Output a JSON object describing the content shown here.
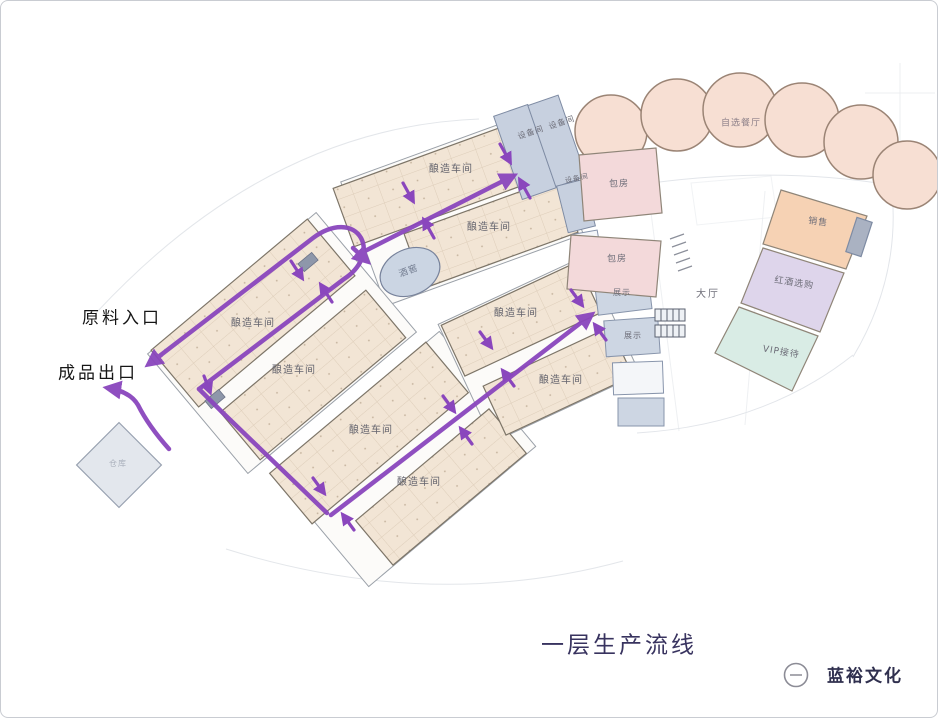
{
  "title": "一层生产流线",
  "flow_labels": {
    "entrance": "原料入口",
    "exit": "成品出口"
  },
  "logo": {
    "name": "蓝裕文化"
  },
  "rooms": {
    "workshops": [
      "酿造车间",
      "酿造车间",
      "酿造车间",
      "酿造车间",
      "酿造车间",
      "酿造车间",
      "酿造车间",
      "酿造车间"
    ],
    "restaurant": "自选餐厅",
    "equipment": [
      "设备间",
      "设备间",
      "设备间"
    ],
    "private_rooms": [
      "包房",
      "包房"
    ],
    "display": [
      "展示",
      "展示"
    ],
    "hall": "大厅",
    "sales": "销售",
    "wine_selection": "红酒选购",
    "vip": "VIP接待",
    "cellar": "酒窖",
    "warehouse": "仓库"
  },
  "colors": {
    "flow_line": "#8a46bd",
    "workshop_fill": "#f2e5d5",
    "restaurant_circle_fill": "#f7dfd3",
    "equipment_fill": "#c7d0df",
    "private_room_fill": "#f3d9da",
    "sales_fill": "#f6d2b4",
    "wine_selection_fill": "#ded5eb",
    "vip_fill": "#d9ece5",
    "cellar_fill": "#cbd5e3",
    "title_color": "#38335f"
  }
}
